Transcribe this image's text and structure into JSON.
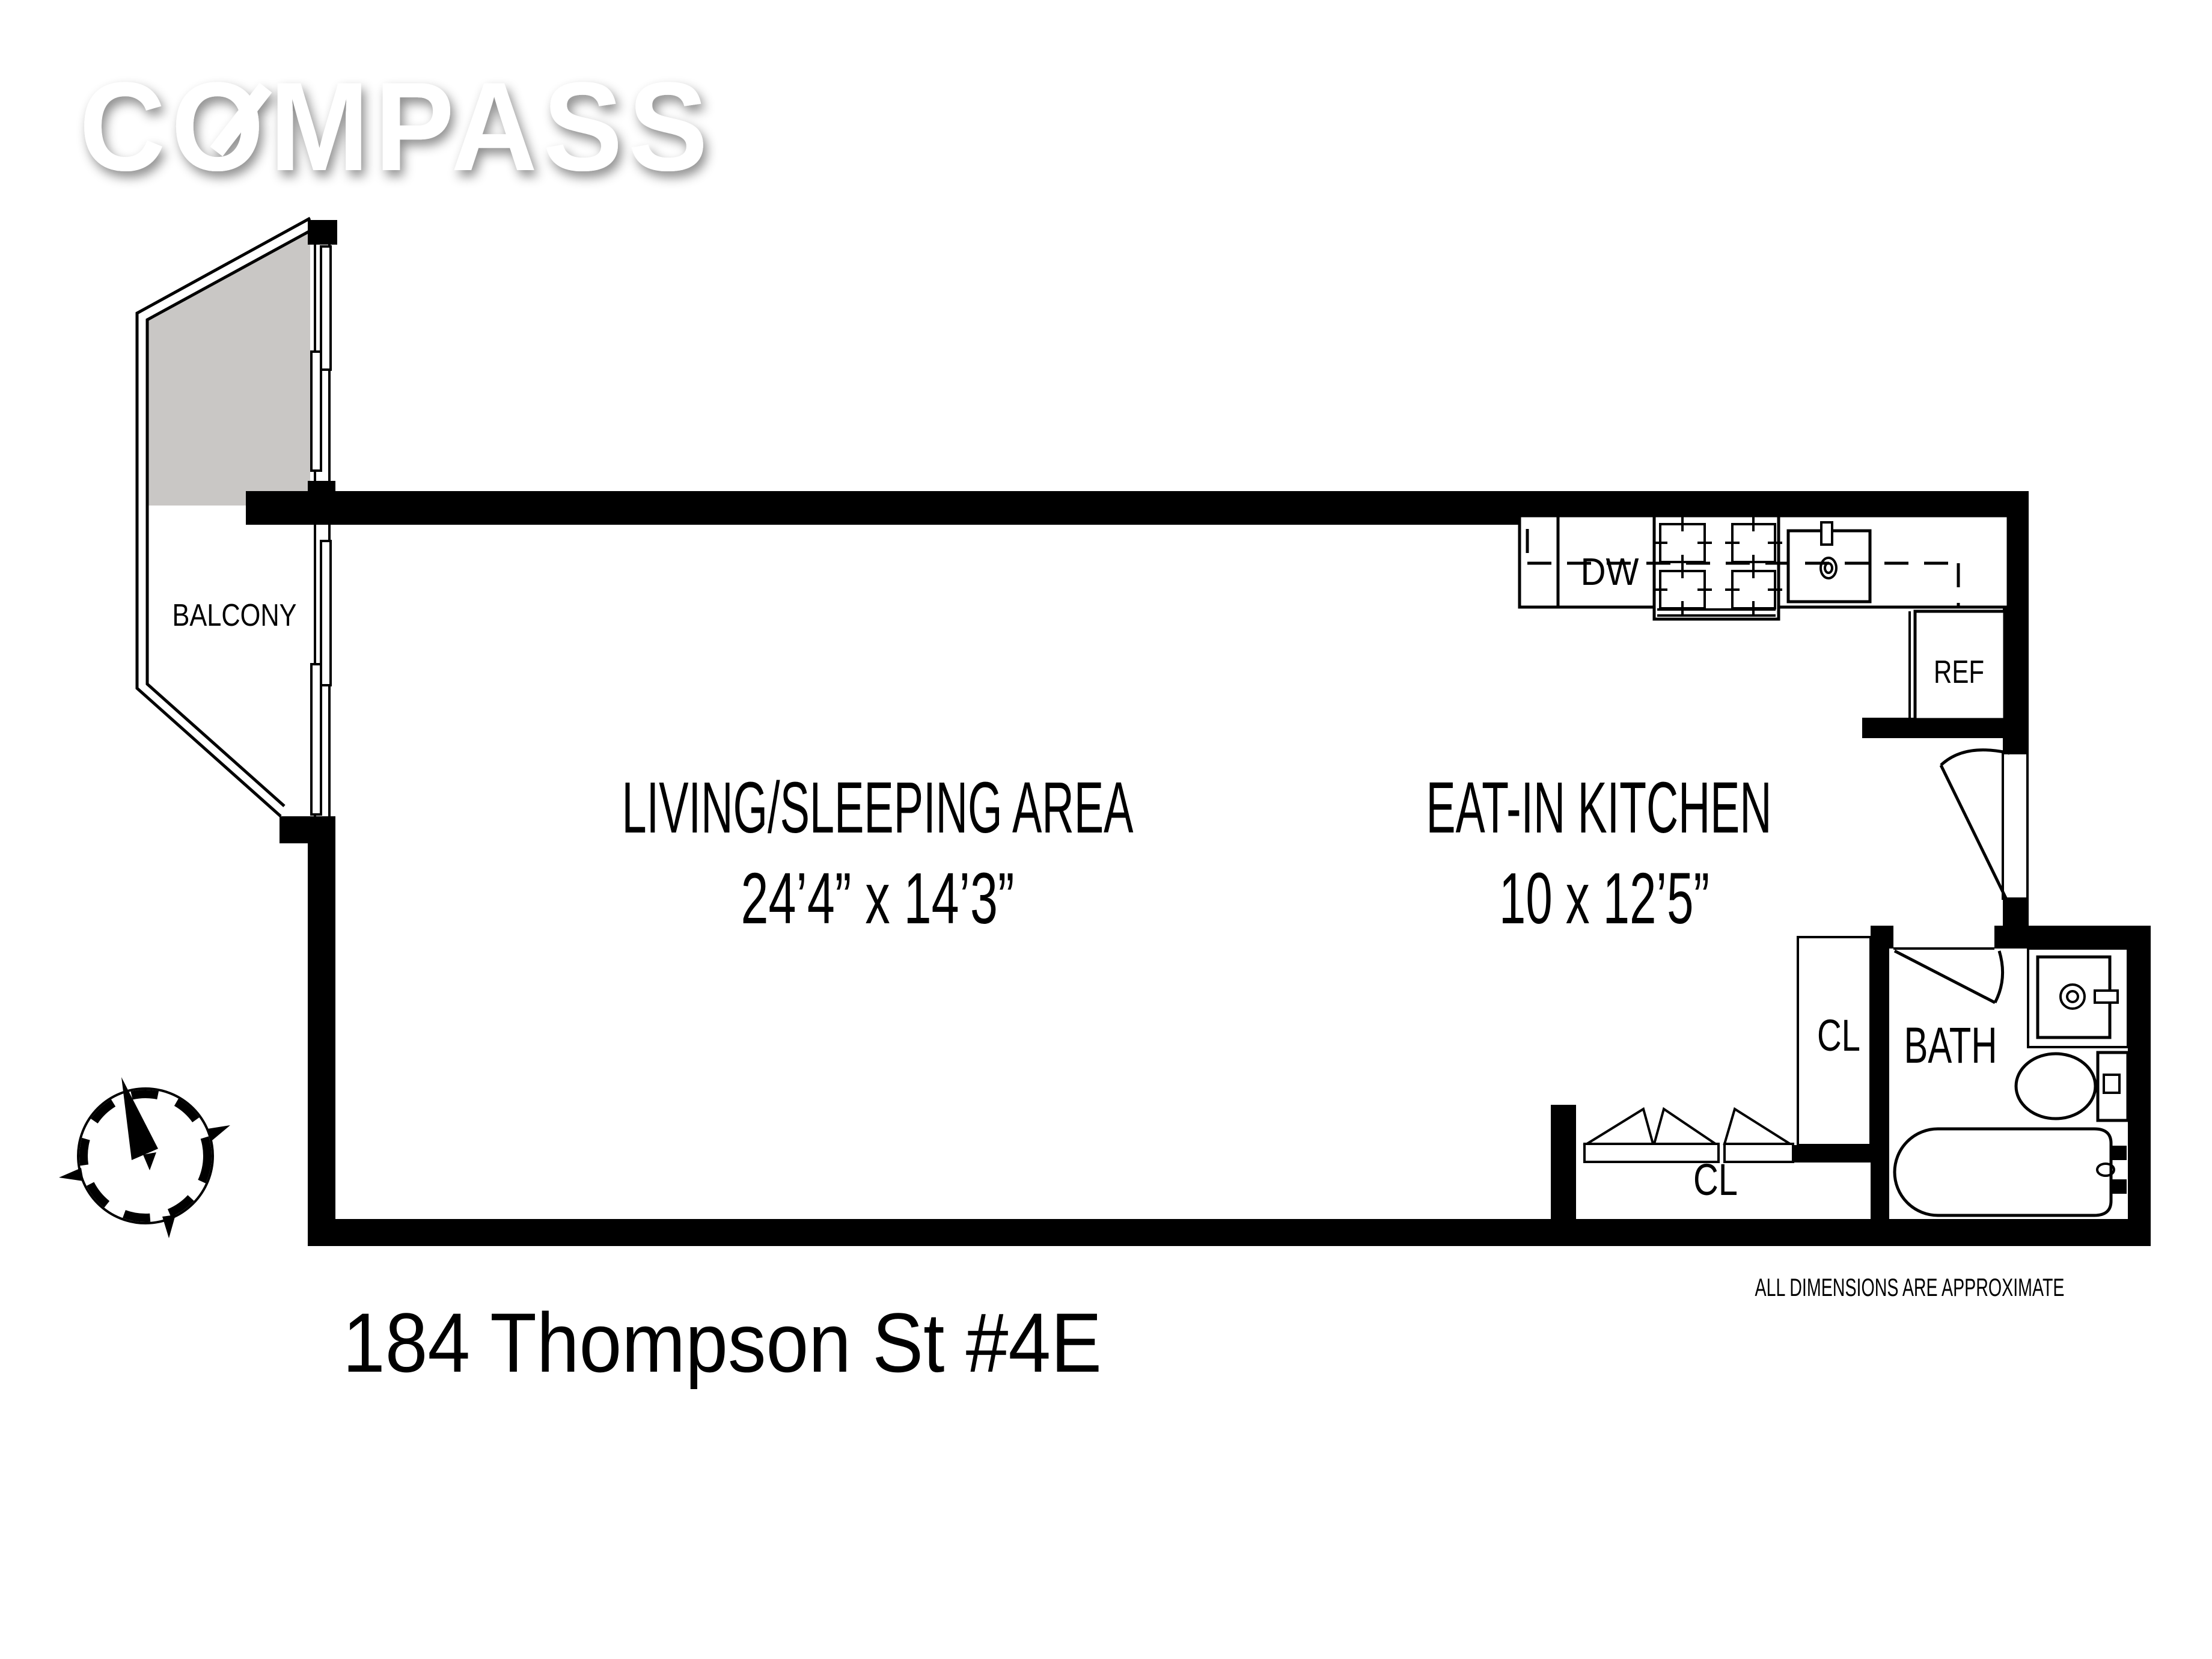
{
  "logo": {
    "text": "COMPASS"
  },
  "title": "184 Thompson St #4E",
  "plan": {
    "balcony_label": "BALCONY",
    "living": {
      "name": "LIVING/SLEEPING AREA",
      "dims": "24’4” x 14’3”"
    },
    "kitchen": {
      "name": "EAT-IN KITCHEN",
      "dims": "10 x 12’5”",
      "dishwasher": "DW",
      "refrigerator": "REF"
    },
    "bath": {
      "name": "BATH"
    },
    "closets": {
      "hall": "CL",
      "bottom": "CL"
    },
    "disclaimer": "ALL DIMENSIONS ARE APPROXIMATE"
  },
  "compass_rose": {
    "north": "N"
  },
  "colors": {
    "wall": "#000000",
    "balcony_shade": "#c9c7c5",
    "background": "#ffffff",
    "logo": "#ffffff"
  }
}
